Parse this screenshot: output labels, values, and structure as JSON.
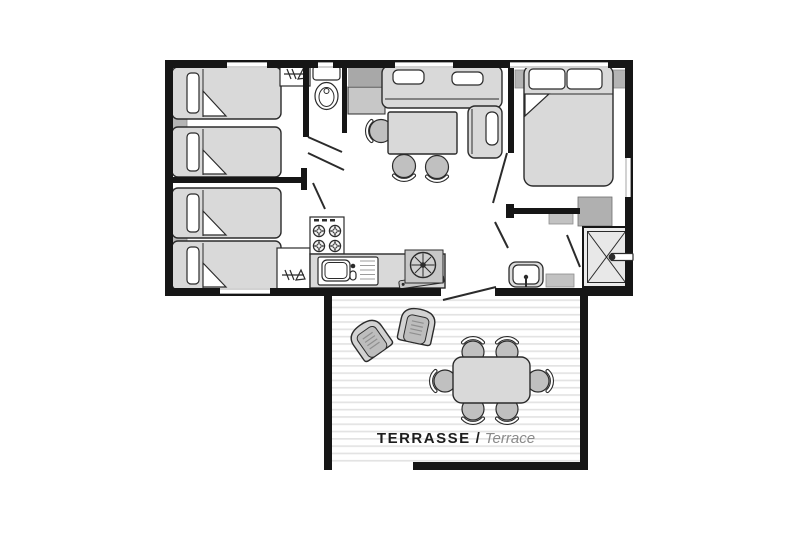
{
  "page": {
    "background": "#ffffff"
  },
  "terrace_label": {
    "primary": "TERRASSE",
    "separator": "/",
    "secondary": "Terrace"
  },
  "colors": {
    "page": "#ffffff",
    "wall": "#161616",
    "outline": "#2b2b2b",
    "furn_light": "#d9d9d9",
    "furn_mid": "#c7c7c7",
    "furn_dark": "#a8a8a8",
    "headboard": "#b4b4b4",
    "seat": "#c0c0c0",
    "deck_line": "#e3e3e3",
    "window_inner": "#a6a6a6",
    "text_primary": "#1d1d1d",
    "text_secondary": "#8a8a8a"
  },
  "plan": {
    "type": "mobile-home floor plan",
    "rooms": [
      {
        "name": "bedroom-twin-top",
        "furniture": [
          "single-bed",
          "single-bed",
          "headboard-shelf",
          "wardrobe"
        ]
      },
      {
        "name": "bedroom-twin-bottom",
        "furniture": [
          "single-bed",
          "single-bed",
          "headboard-shelf",
          "wardrobe"
        ]
      },
      {
        "name": "wc",
        "furniture": [
          "toilet"
        ]
      },
      {
        "name": "living-kitchen",
        "furniture": [
          "corner-sofa",
          "sofa-cushions",
          "dining-table",
          "three-chairs",
          "tv-cabinet",
          "stove-4-burners",
          "kitchen-counter",
          "kitchen-sink",
          "round-appliance"
        ]
      },
      {
        "name": "bedroom-double",
        "furniture": [
          "double-bed",
          "two-pillows",
          "bedside-shelf-left",
          "bedside-shelf-right",
          "corner-storage"
        ]
      },
      {
        "name": "shower-room",
        "furniture": [
          "shower",
          "washbasin",
          "cabinet"
        ]
      },
      {
        "name": "terrace",
        "furniture": [
          "lounge-chair",
          "lounge-chair",
          "outdoor-table",
          "six-chairs"
        ]
      }
    ]
  }
}
